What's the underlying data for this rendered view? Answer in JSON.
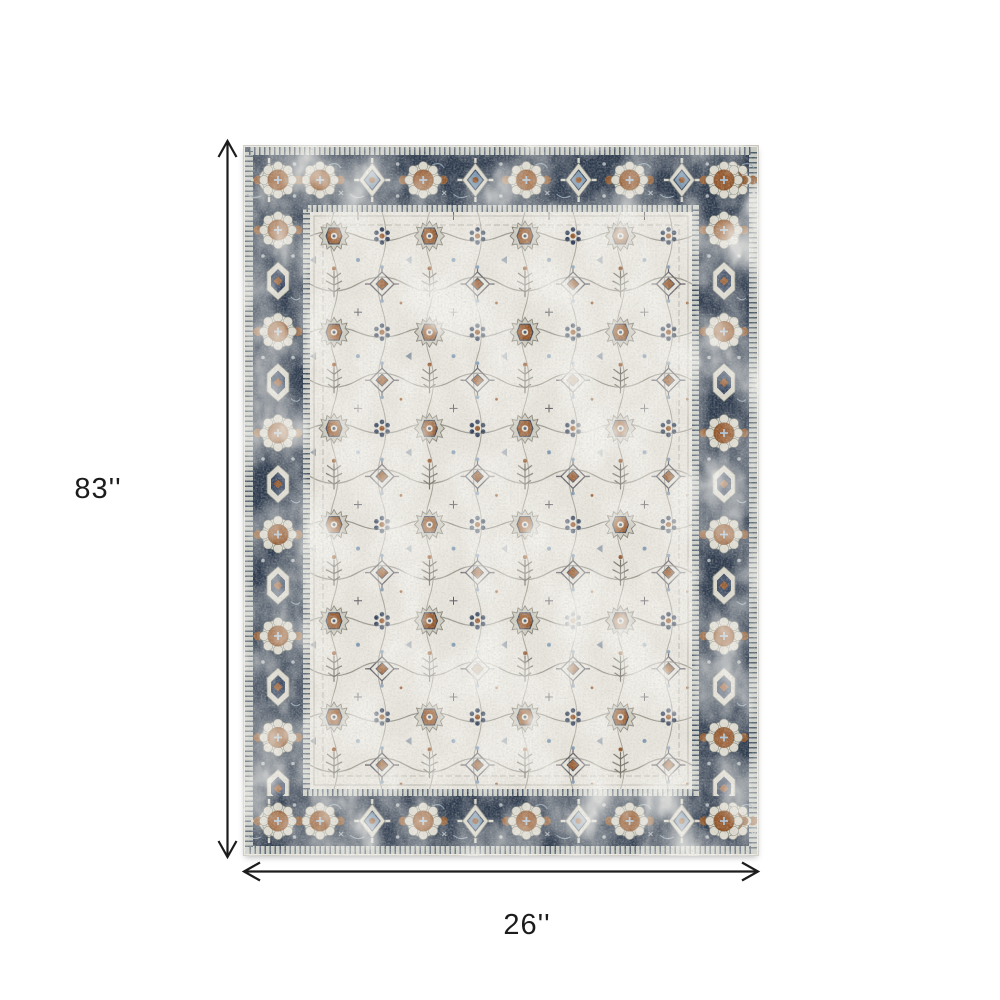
{
  "figure": {
    "background_color": "#ffffff",
    "description": "Area rug product image with height and width dimension arrows"
  },
  "dimensions": {
    "height_label": "83''",
    "width_label": "26''",
    "arrow_color": "#1c1c1c"
  },
  "rug": {
    "name": "distressed vintage oriental area rug",
    "pattern": "ivory medallion field with ornate navy rosette border",
    "colors": {
      "field_ivory": "#e9e6de",
      "border_navy": "#2e3b4e",
      "accent_rust": "#96572a",
      "accent_blue": "#7d98b3",
      "accent_slate": "#33425c",
      "outline_gray": "#8f8d82",
      "guard_light": "#c8cbc4",
      "binding_white": "#eceae3"
    }
  }
}
